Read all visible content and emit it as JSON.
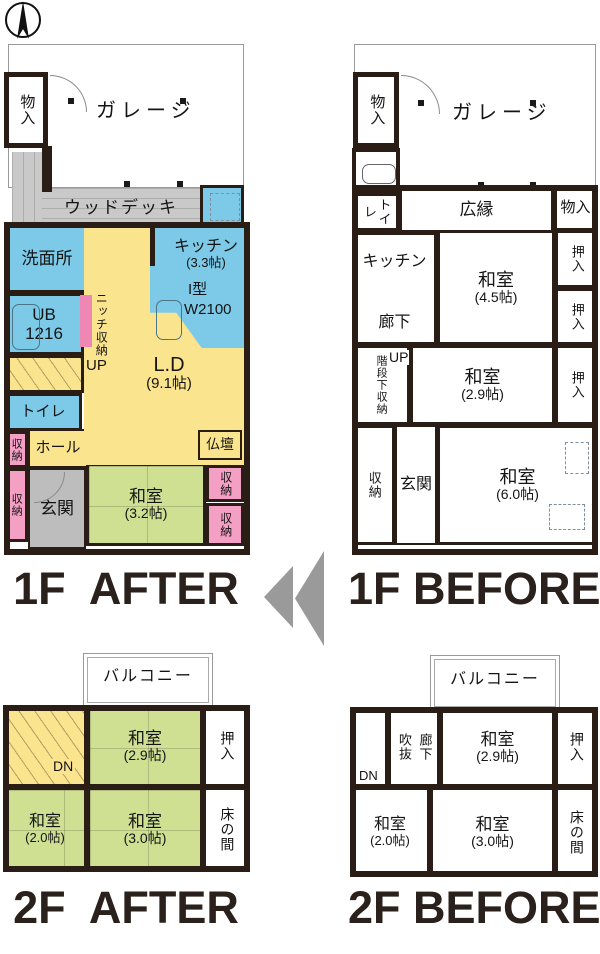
{
  "compass": {
    "icon": "north-arrow"
  },
  "captions": {
    "f1_after": "1F  AFTER",
    "f1_before": "1F BEFORE",
    "f2_after": "2F  AFTER",
    "f2_before": "2F BEFORE"
  },
  "colors": {
    "wall": "#2A1D16",
    "wet": "#7CC9E8",
    "warm": "#FBE48E",
    "tatami_green": "#CFE093",
    "pink": "#F49FC4",
    "pink_deep": "#EE87B4",
    "entry_gray": "#BDBDBD",
    "deck_gray": "#C9C9C9",
    "arrow_gray": "#9A9A9A",
    "caption": "#2A211C"
  },
  "plans": {
    "f1a": {
      "rooms": {
        "garage": "ガレージ",
        "storage_top": "物入",
        "deck": "ウッドデッキ",
        "washroom": "洗面所",
        "kitchen": "キッチン",
        "kitchen_size": "(3.3帖)",
        "kitchen_type": "I型",
        "kitchen_width": "W2100",
        "bath": "UB",
        "bath_size": "1216",
        "niche": "ニッチ収納",
        "up": "UP",
        "living": "L.D",
        "living_size": "(9.1帖)",
        "toilet": "トイレ",
        "hall": "ホール",
        "hall_storage": "収納",
        "altar": "仏壇",
        "entry": "玄関",
        "entry_storage": "収納",
        "tatami": "和室",
        "tatami_size": "(3.2帖)",
        "storage_r1": "収納",
        "storage_r2": "収納"
      }
    },
    "f1b": {
      "rooms": {
        "garage": "ガレージ",
        "storage_top": "物入",
        "toilet": "トイレ",
        "veranda": "広縁",
        "storage_right": "物入",
        "kitchen": "キッチン",
        "corridor": "廊下",
        "tatami45": "和室",
        "tatami45_size": "(4.5帖)",
        "closet1": "押入",
        "closet2": "押入",
        "stair_storage": "階段下収納",
        "up": "UP",
        "tatami29": "和室",
        "tatami29_size": "(2.9帖)",
        "closet3": "押入",
        "storage": "収納",
        "entry": "玄関",
        "tatami60": "和室",
        "tatami60_size": "(6.0帖)"
      }
    },
    "f2a": {
      "rooms": {
        "balcony": "バルコニー",
        "dn": "DN",
        "tatami29": "和室",
        "tatami29_size": "(2.9帖)",
        "closet": "押入",
        "tatami20": "和室",
        "tatami20_size": "(2.0帖)",
        "tatami30": "和室",
        "tatami30_size": "(3.0帖)",
        "tokonoma": "床の間"
      }
    },
    "f2b": {
      "rooms": {
        "balcony": "バルコニー",
        "void": "吹抜",
        "corridor": "廊下",
        "dn": "DN",
        "tatami29": "和室",
        "tatami29_size": "(2.9帖)",
        "closet": "押入",
        "tatami20": "和室",
        "tatami20_size": "(2.0帖)",
        "tatami30": "和室",
        "tatami30_size": "(3.0帖)",
        "tokonoma": "床の間"
      }
    }
  }
}
